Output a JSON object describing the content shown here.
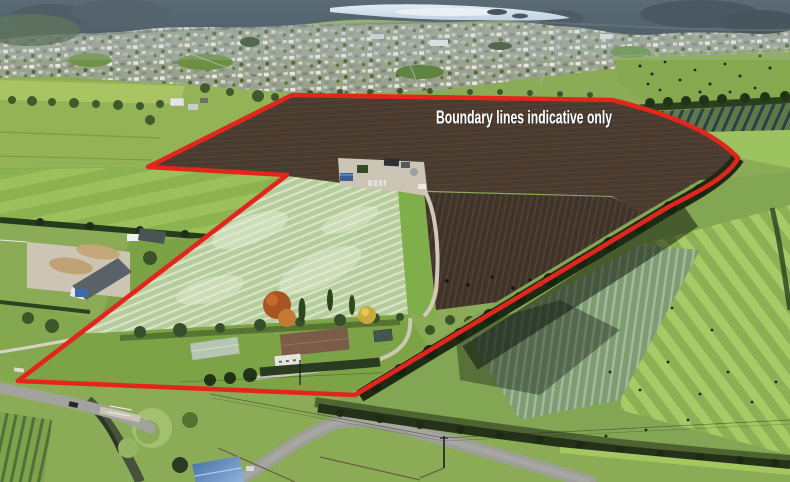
{
  "overlay": {
    "label": "Boundary lines indicative only",
    "label_color": "#ffffff",
    "line_color": "#e2261c"
  }
}
